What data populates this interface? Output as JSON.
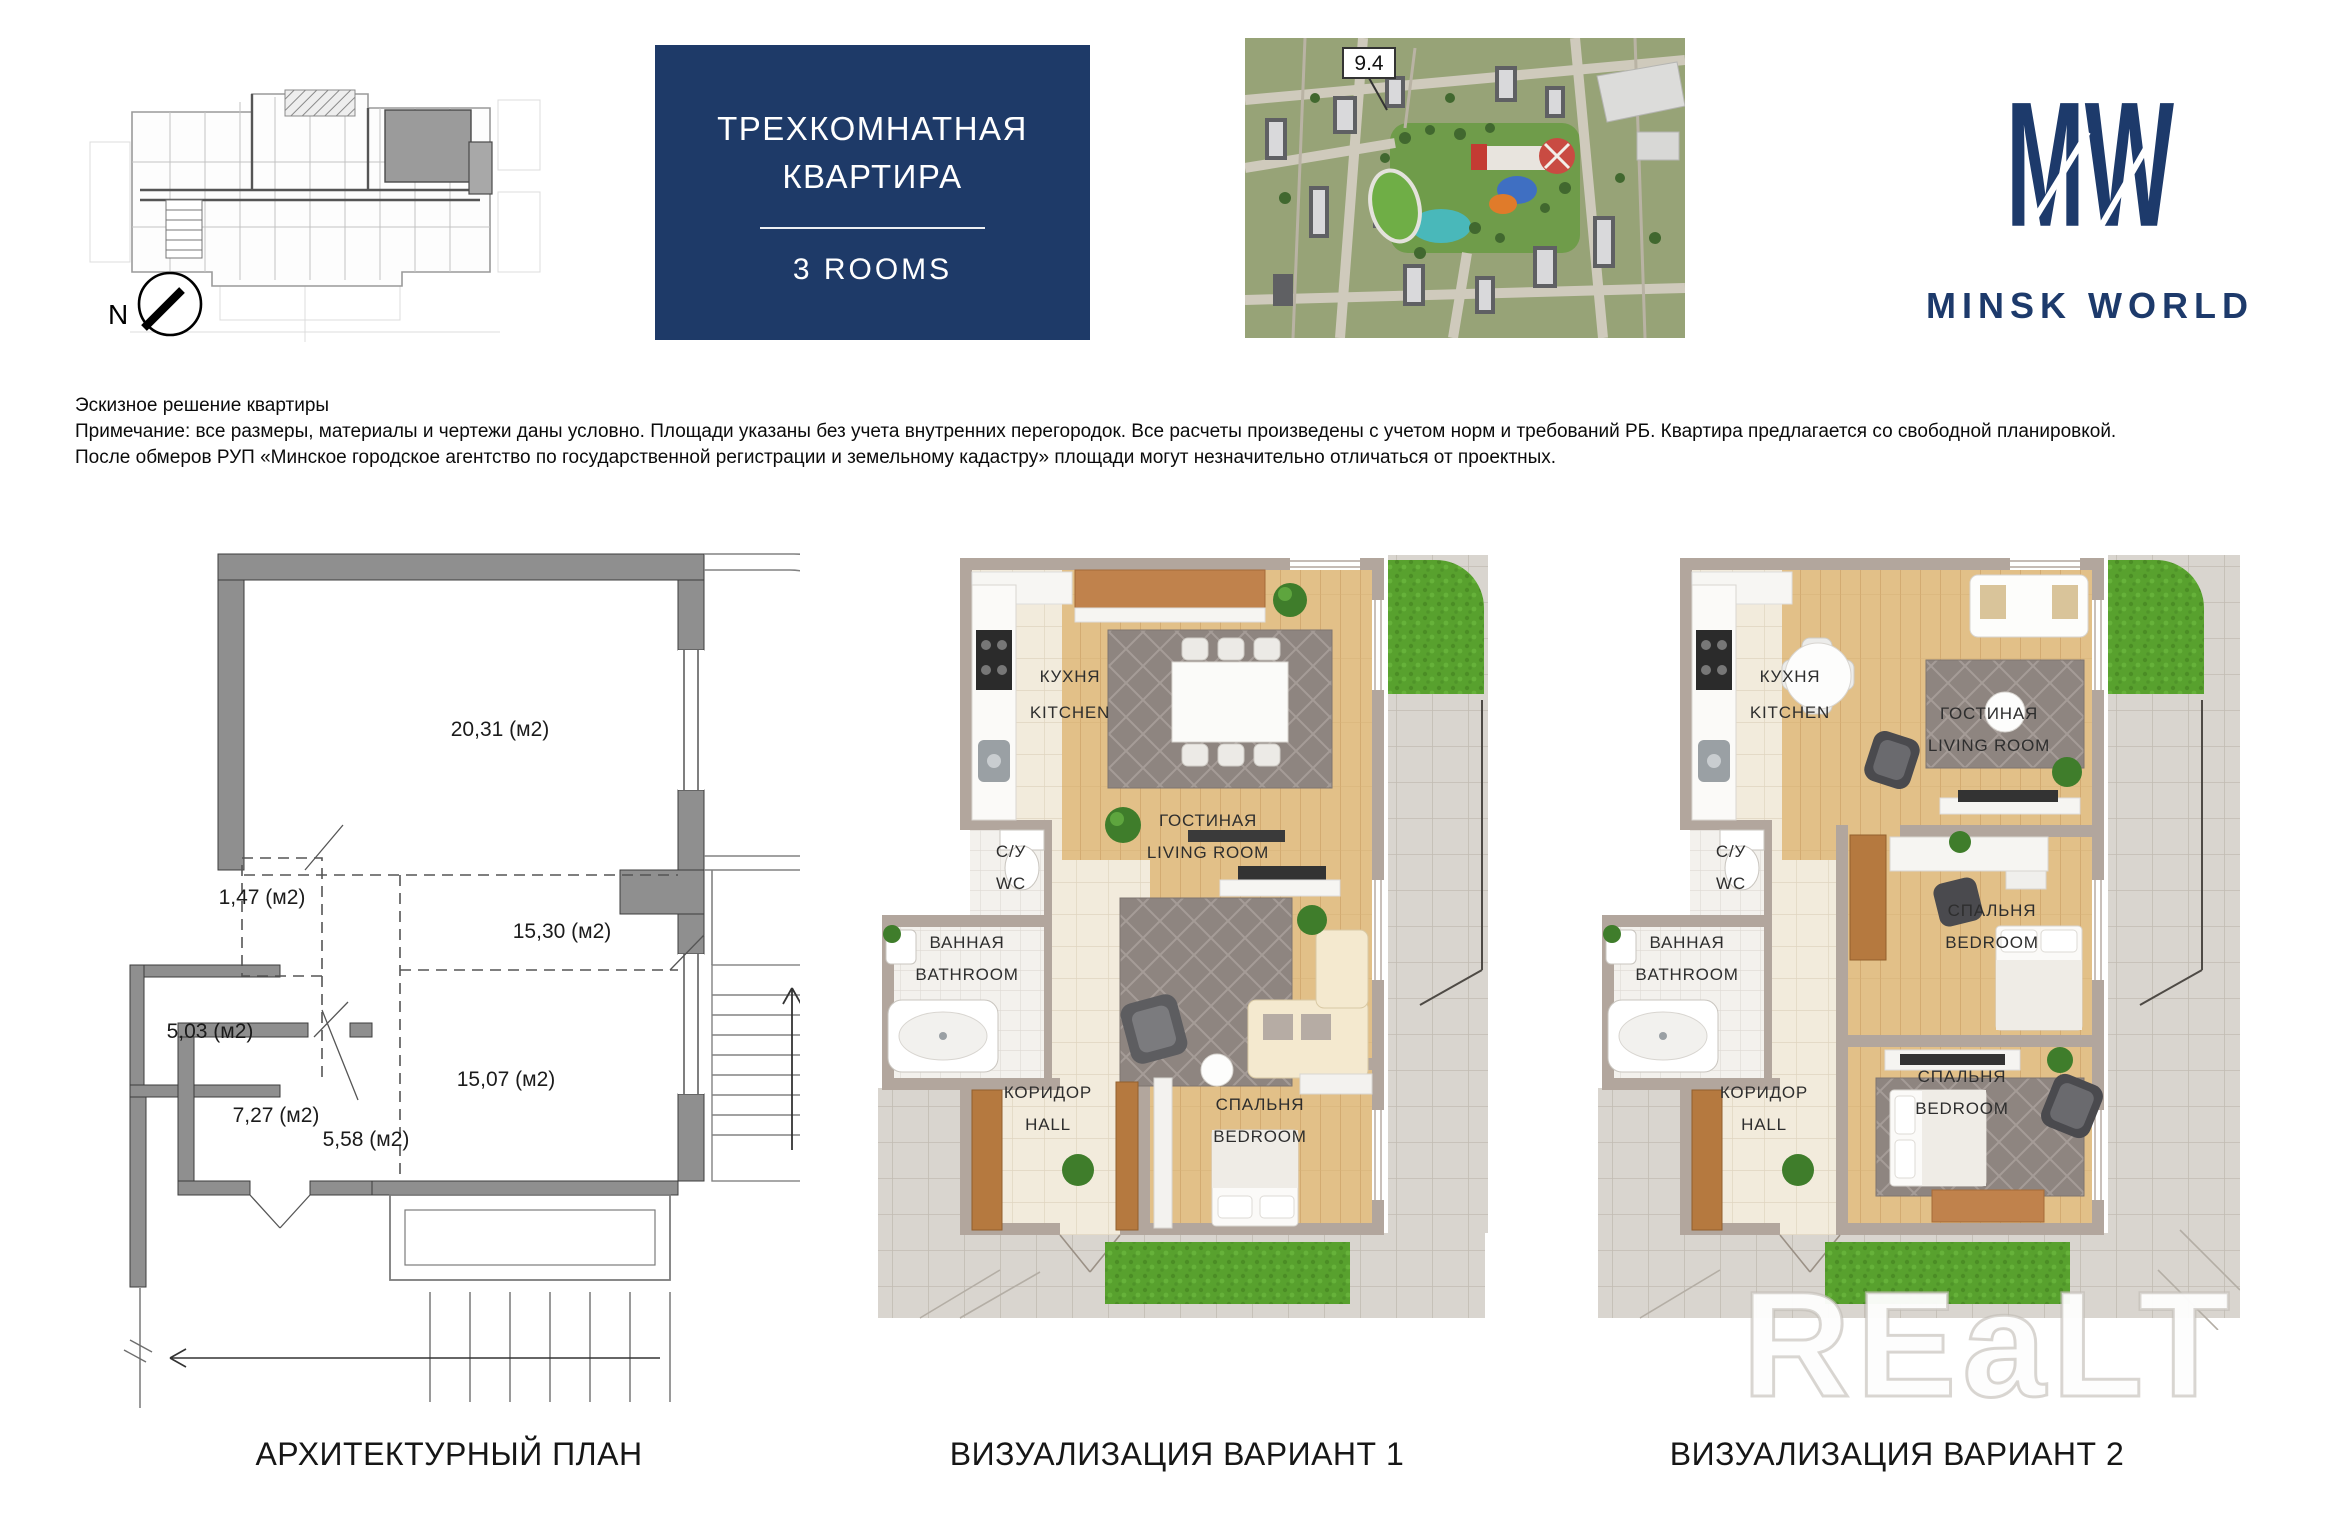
{
  "header": {
    "title_line1": "ТРЕХКОМНАТНАЯ",
    "title_line2": "КВАРТИРА",
    "title_sub": "3 ROOMS",
    "map_badge": "9.4",
    "compass_label": "N",
    "logo_monogram": "MW",
    "logo_name": "MINSK WORLD"
  },
  "disclaimer": {
    "line1": "Эскизное решение квартиры",
    "line2": "Примечание: все размеры, материалы и чертежи даны условно. Площади указаны без учета внутренних перегородок. Все расчеты произведены с учетом норм и требований РБ. Квартира предлагается со свободной планировкой.",
    "line3": "После обмеров РУП «Минское городское агентство по государственной регистрации и земельному кадастру» площади могут незначительно отличаться от проектных."
  },
  "arch_plan": {
    "areas": {
      "room_top": "20,31 (м2)",
      "closet": "1,47 (м2)",
      "room_mid": "15,30 (м2)",
      "bathroom": "5,03 (м2)",
      "corridor": "5,58 (м2)",
      "room_small": "7,27 (м2)",
      "room_bottom": "15,07 (м2)"
    }
  },
  "room_labels": {
    "kitchen_ru": "КУХНЯ",
    "kitchen_en": "KITCHEN",
    "wc_ru": "С/У",
    "wc_en": "WC",
    "bathroom_ru": "ВАННАЯ",
    "bathroom_en": "BATHROOM",
    "living_ru": "ГОСТИНАЯ",
    "living_en": "LIVING ROOM",
    "hall_ru": "КОРИДОР",
    "hall_en": "HALL",
    "bedroom_ru": "СПАЛЬНЯ",
    "bedroom_en": "BEDROOM"
  },
  "captions": {
    "arch": "АРХИТЕКТУРНЫЙ ПЛАН",
    "variant1": "ВИЗУАЛИЗАЦИЯ ВАРИАНТ 1",
    "variant2": "ВИЗУАЛИЗАЦИЯ ВАРИАНТ 2"
  },
  "watermark": "REaLT",
  "colors": {
    "navy": "#1e3a68",
    "wall": "#b2a69d",
    "wood": "#e2c088",
    "grass": "#58a12e",
    "terrace": "#d9d5cf"
  }
}
